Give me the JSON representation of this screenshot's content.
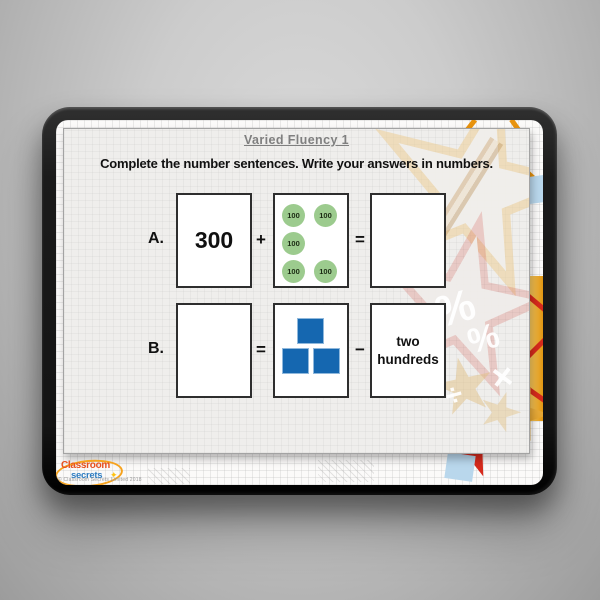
{
  "slide": {
    "title": "Varied Fluency 1",
    "instruction": "Complete the number sentences. Write your answers in numbers.",
    "rows": [
      {
        "label": "A.",
        "box1": "300",
        "op1": "+",
        "op2": "=",
        "box3": "",
        "counters": [
          "100",
          "100",
          "100",
          "100",
          "100"
        ],
        "counter_count": 5
      },
      {
        "label": "B.",
        "box1": "",
        "op1": "=",
        "op2": "−",
        "box3": "two hundreds",
        "blocks": 3
      }
    ]
  },
  "decorations": {
    "percent1": "%",
    "percent2": "%",
    "multiply": "×",
    "divide": "÷"
  },
  "footer": {
    "logo": {
      "line1": "Classroom",
      "line2": "secrets",
      "star": "✦"
    },
    "copyright": "© Classroom Secrets Limited 2018"
  },
  "colors": {
    "counter_green": "#9ccb8e",
    "block_blue": "#1567b0",
    "title_gray": "#7f7f7f",
    "logo_red": "#e8501e",
    "logo_blue": "#2f7dc1",
    "logo_orange": "#f6a21d",
    "logo_star_yellow": "#ffc20e",
    "accent_orange": "#e8930e",
    "accent_red": "#d62a1c",
    "accent_gold": "#eab959",
    "accent_lightblue": "#b9d7ec"
  }
}
